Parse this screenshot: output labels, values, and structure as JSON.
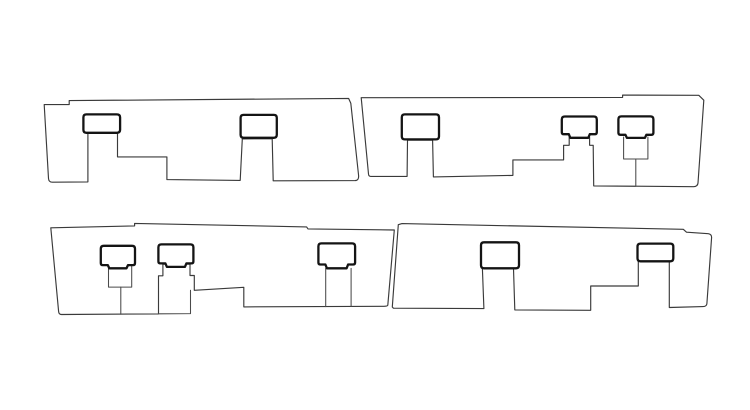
{
  "figure": {
    "background_color": "#ffffff",
    "outline_color": "#3a3a3a",
    "clip_color": "#141414",
    "canvas_width": "750",
    "canvas_height": "410",
    "viewbox": "0 0 750 410"
  },
  "panels": [
    {
      "name": "top-left-panel",
      "outline": "M 44.2,104.6 L 69.2,104.6 L 69.2,100.6 L 348.6,98.4 L 350.8,103.2 L 358.6,175.5 Q 359,180.5 355,180.6 L 273.2,180.8 L 272.2,138.7 L 242.3,138.9 L 240.2,180.4 L 166.9,179.6 L 166.9,156.9 L 117.5,156.9 L 117.5,133.1 L 87.9,133.1 L 87.9,181.9 L 52.5,182.2 Q 48.8,182.3 48.5,178.5 Z",
      "clips": [
        "M 86.4,114.4 L 116.8,114.4 Q 120.1,114.4 120.1,117.4 L 120.1,129.8 Q 120.1,132.8 116.8,132.8 L 86.4,132.8 Q 83.4,132.8 83.4,129.8 L 83.4,117.4 Q 83.4,114.4 86.4,114.4 Z",
        "M 243.6,114.9 L 273.8,114.9 Q 276.8,114.9 276.8,117.9 L 276.8,134.8 Q 276.8,137.8 273.8,137.8 L 243.6,137.8 Q 240.6,137.8 240.6,134.8 L 240.6,117.9 Q 240.6,114.9 243.6,114.9 Z"
      ]
    },
    {
      "name": "top-right-panel",
      "outline": "M 361.2,97.7 L 622.6,97.4 L 622.6,95.1 L 698.8,95.3 L 703.8,100.2 L 698,183 Q 697.6,186.6 693.5,186.7 L 593.7,185.9 L 593.2,145.3 L 589.6,145.3 L 589.6,137.2 L 569.2,137.2 L 569.2,145.3 L 563.6,145.3 L 563.6,159.9 L 512.9,159.9 L 512.9,175.4 L 433.4,176.9 L 432.6,140.2 L 407.5,140.2 L 407.1,176.4 L 370.8,176.4 Q 368.7,176.4 368.5,174 Z",
      "cuts": [
        "M 623.6,137 L 623.6,159 L 647.9,159 L 647.9,137",
        "M 635.8,159 L 635.8,186.3"
      ],
      "clips": [
        "M 404.8,114.4 L 436,114.4 Q 439,114.4 439,117.4 L 439,136.4 Q 439,139.4 436,139.4 L 404.8,139.4 Q 401.8,139.4 401.8,136.4 L 401.8,117.4 Q 401.8,114.4 404.8,114.4 Z",
        "M 564.8,116.5 L 593.8,116.5 Q 596.8,116.5 596.8,119.5 L 596.8,132.2 Q 596.8,134.2 594.8,134.2 L 589.8,134.2 L 588.3,137.8 L 570.3,137.8 L 568.8,134.2 L 563.8,134.2 Q 561.8,134.2 561.8,132.2 L 561.8,119.5 Q 561.8,116.5 564.8,116.5 Z",
        "M 621.4,116.4 L 650.4,116.4 Q 653.4,116.4 653.4,119.4 L 653.4,132.8 Q 653.4,134.8 651.4,134.8 L 646.4,134.8 L 644.9,137.9 L 626.9,137.9 L 625.4,134.8 L 620.4,134.8 Q 618.4,134.8 618.4,132.8 L 618.4,119.4 Q 618.4,116.4 621.4,116.4 Z"
      ]
    },
    {
      "name": "bottom-left-panel",
      "outline": "M 50.8,227.8 L 134.6,225.9 L 134.6,223.4 L 306.6,226.9 L 308,228.9 L 394.3,230 L 387.8,305.2 Q 387.4,306.3 384,306.3 L 243.8,306.9 L 243.8,287.3 L 194.3,290.3 L 194.3,275.5 L 190,275.5 L 190,264.2 L 162.9,264.2 L 162.9,275.8 L 158.5,275.8 L 158.5,313.9 L 61.5,314.5 Q 58.8,314.5 58.6,311.3 Z",
      "cuts": [
        "M 158.5,313.8 L 190.5,313.6 L 190.5,290.3",
        "M 108.5,265.2 L 108.5,287.1 L 131.7,287.1 L 131.7,265.2",
        "M 120.8,287.1 L 120.8,314.2",
        "M 325.7,268.4 L 325.7,306.6",
        "M 351.1,268.4 L 351.1,306.4"
      ],
      "clips": [
        "M 103.8,245.8 L 132,245.8 Q 135,245.8 135,248.8 L 135,263.1 Q 135,265.1 133,265.1 L 128,265.1 L 126.5,268.3 L 109.3,268.3 L 107.8,265.1 L 102.8,265.1 Q 100.8,265.1 100.8,263.1 L 100.8,248.8 Q 100.8,245.8 103.8,245.8 Z",
        "M 161.4,244.4 L 190.4,244.4 Q 193.4,244.4 193.4,247.4 L 193.4,261.4 Q 193.4,263.4 191.4,263.4 L 186.4,263.4 L 184.9,266.9 L 166.9,266.9 L 165.4,263.4 L 160.4,263.4 Q 158.4,263.4 158.4,261.4 L 158.4,247.4 Q 158.4,244.4 161.4,244.4 Z",
        "M 321.4,243.4 L 352.1,243.4 Q 355.1,243.4 355.1,246.4 L 355.1,262.5 Q 355.1,264.5 353.1,264.5 L 348.1,264.5 L 346.6,268.3 L 326.9,268.3 L 325.4,264.5 L 320.4,264.5 Q 318.4,264.5 318.4,262.5 L 318.4,246.4 Q 318.4,243.4 321.4,243.4 Z"
      ]
    },
    {
      "name": "bottom-right-panel",
      "outline": "M 398.3,224.7 L 402,223.6 L 683.3,229.3 L 686.5,232.2 L 708.3,233.7 Q 711.7,234.2 711.6,237.5 L 706.9,303.5 Q 706.7,306.5 703,306.6 L 669.3,307.5 L 669.3,261.4 L 638.3,261.4 L 638.3,286 L 590.7,286 L 590.7,310.3 L 514.8,309.9 L 513.5,268.6 L 482.4,268.6 L 483.9,308.6 L 393.4,308.2 L 392.3,307 Z",
      "clips": [
        "M 484,242.3 L 516,242.3 Q 519,242.3 519,245.3 L 519,265.3 Q 519,268.3 516,268.3 L 484,268.3 Q 481,268.3 481,265.3 L 481,245.3 Q 481,242.3 484,242.3 Z",
        "M 640.5,243.6 L 670.3,243.6 Q 673.3,243.6 673.3,246.6 L 673.3,258.3 Q 673.3,261.3 670.3,261.3 L 640.5,261.3 Q 637.5,261.3 637.5,258.3 L 637.5,246.6 Q 637.5,243.6 640.5,243.6 Z"
      ]
    }
  ]
}
